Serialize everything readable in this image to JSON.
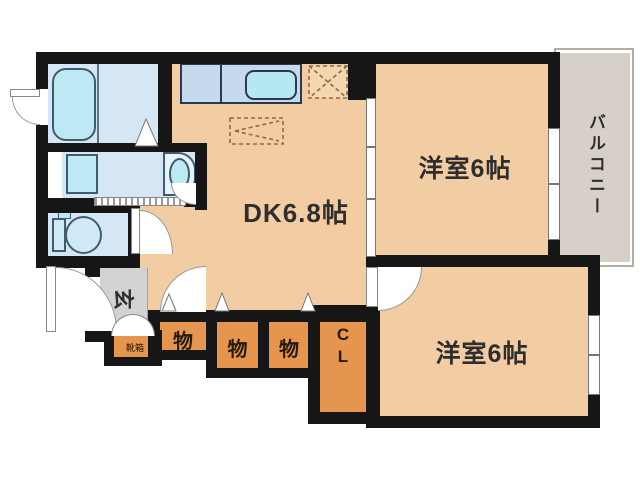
{
  "rooms": {
    "dk": {
      "label": "DK6.8帖"
    },
    "bedroom_top": {
      "label": "洋室6帖"
    },
    "bedroom_bottom": {
      "label": "洋室6帖"
    },
    "balcony": {
      "label": "バルコニー"
    },
    "entrance": {
      "label": "玄"
    },
    "shoebox": {
      "label": "靴箱"
    },
    "storage1": {
      "label": "物"
    },
    "storage2": {
      "label": "物"
    },
    "storage3": {
      "label": "物"
    },
    "closet": {
      "line1": "C",
      "line2": "L"
    }
  },
  "fixtures": [
    "bathtub",
    "washing-machine",
    "wash-basin",
    "toilet",
    "kitchen-counter",
    "kitchen-sink",
    "refrigerator-space",
    "dining-table-space",
    "accordion-door",
    "sliding-door",
    "window"
  ],
  "colors": {
    "wall": "#161616",
    "floor": "#f2cda4",
    "storage_orange": "#e6954e",
    "water_room_blue": "#d5e7f5",
    "fixture_cyan": "#bde9f4",
    "counter_blue": "#c6daee",
    "balcony_gray": "#d7d0c8",
    "entrance_gray": "#d2d2d2",
    "balcony_outline": "#b3aca4"
  }
}
